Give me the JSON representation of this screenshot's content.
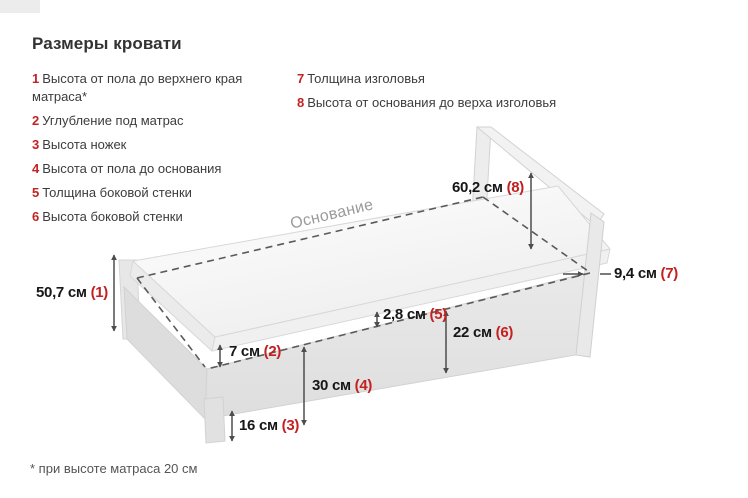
{
  "title": "Размеры кровати",
  "legend": {
    "left": [
      {
        "num": "1",
        "text": "Высота от пола до верхнего края матраса*"
      },
      {
        "num": "2",
        "text": "Углубление под матрас"
      },
      {
        "num": "3",
        "text": "Высота ножек"
      },
      {
        "num": "4",
        "text": "Высота от пола до основания"
      },
      {
        "num": "5",
        "text": "Толщина боковой стенки"
      },
      {
        "num": "6",
        "text": "Высота боковой стенки"
      }
    ],
    "right": [
      {
        "num": "7",
        "text": "Толщина изголовья"
      },
      {
        "num": "8",
        "text": "Высота от основания до верха изголовья"
      }
    ]
  },
  "diagram": {
    "base_label": "Основание",
    "dimensions": [
      {
        "value": "50,7 см",
        "ref": "(1)"
      },
      {
        "value": "7 см",
        "ref": "(2)"
      },
      {
        "value": "16 см",
        "ref": "(3)"
      },
      {
        "value": "30 см",
        "ref": "(4)"
      },
      {
        "value": "2,8 см",
        "ref": "(5)"
      },
      {
        "value": "22 см",
        "ref": "(6)"
      },
      {
        "value": "9,4 см",
        "ref": "(7)"
      },
      {
        "value": "60,2 см",
        "ref": "(8)"
      }
    ]
  },
  "footnote": "* при высоте матраса 20 см",
  "colors": {
    "accent_red": "#c32020",
    "text_dark": "#333333",
    "dimension_text": "#161616",
    "muted_label": "#9a9a9a",
    "line": "#4d4d4d",
    "bed_fill": "#e7e7e7",
    "mattress_fill": "#fafafa"
  }
}
